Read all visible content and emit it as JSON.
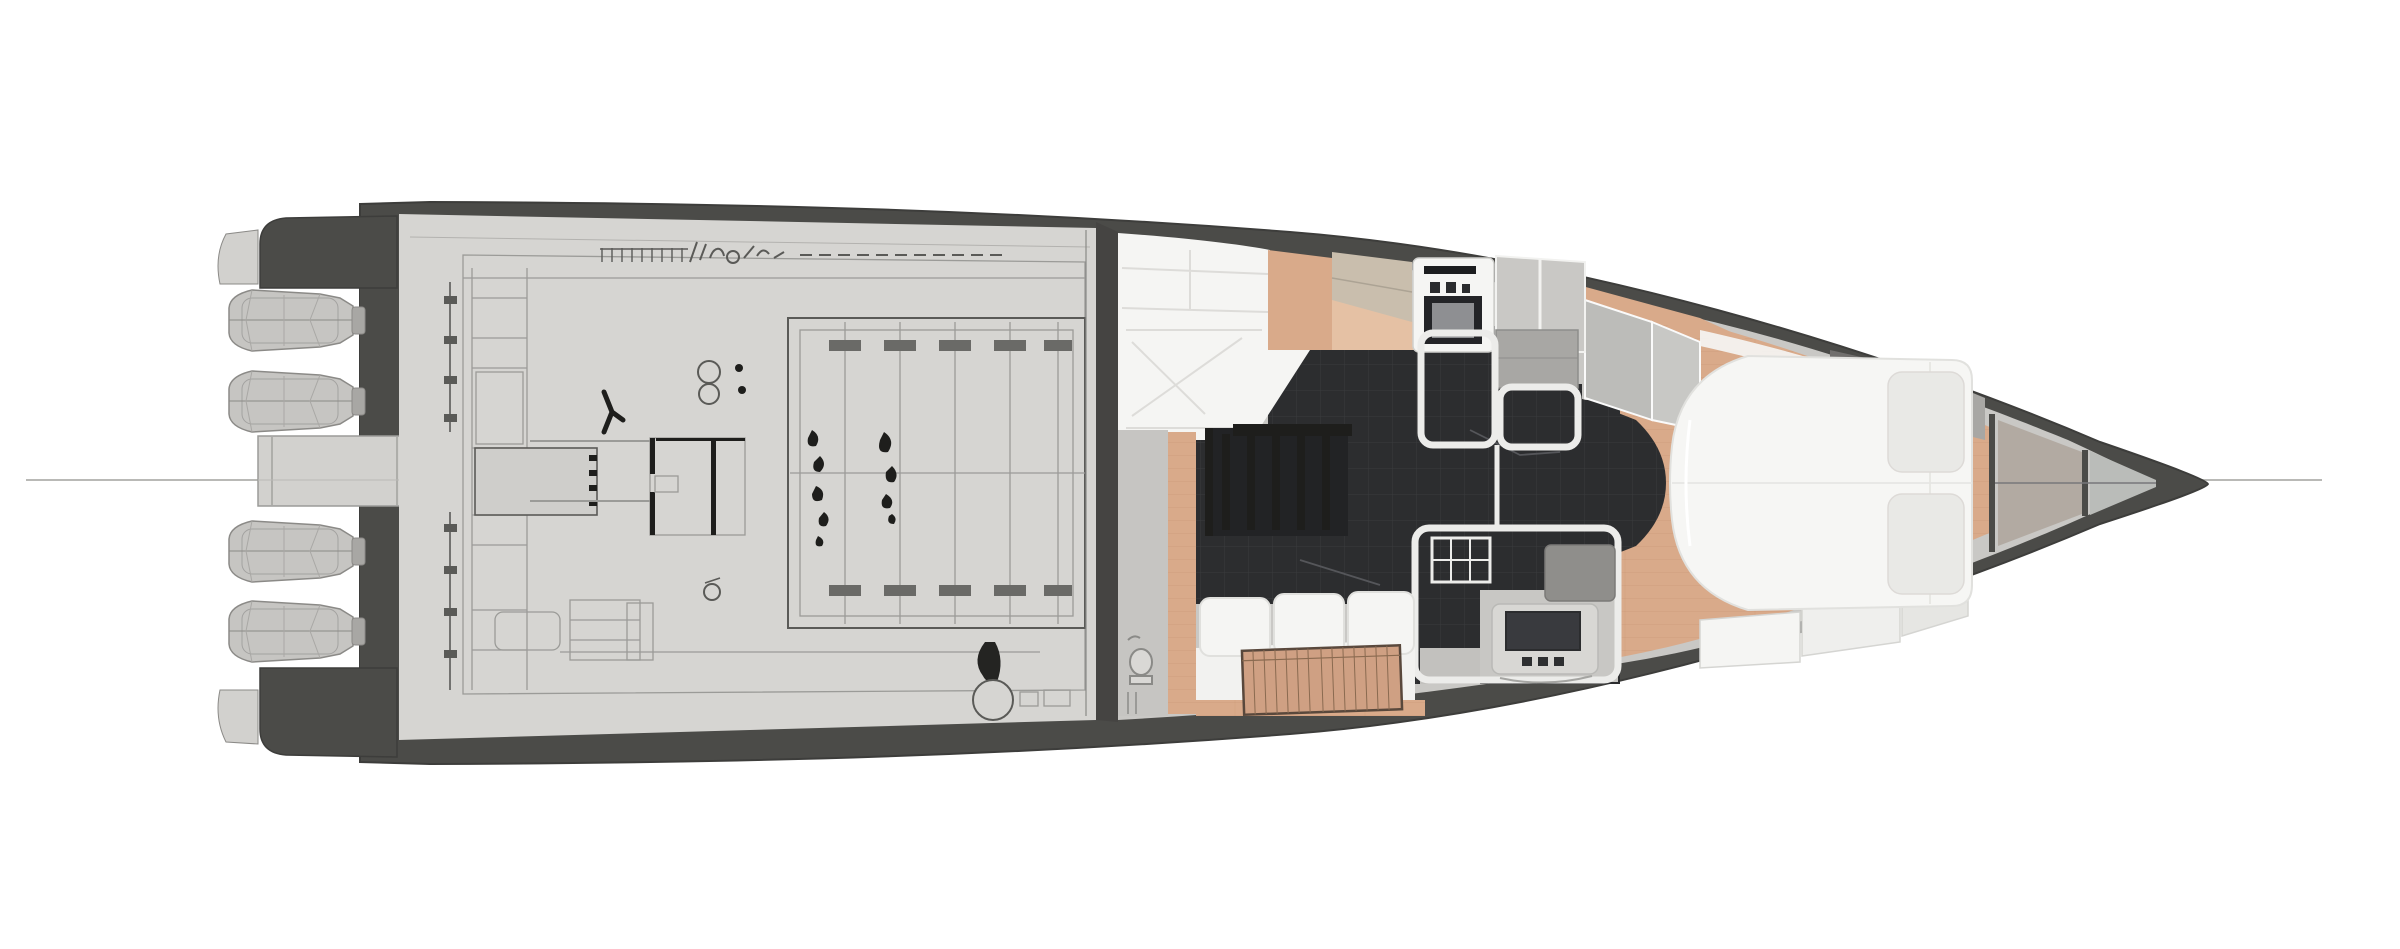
{
  "image": {
    "kind": "yacht-floor-plan-top-view",
    "orientation": "bow-right-stern-left",
    "background": "#ffffff"
  },
  "colors": {
    "bg": "#ffffff",
    "hull": "#4b4b48",
    "hullEdge": "#3d3d3b",
    "deck": "#d6d5d2",
    "deckShade": "#cfcecb",
    "deckLine": "#9b9b98",
    "deckLineDark": "#5a5a57",
    "ink": "#1e1e1c",
    "engine": "#c6c5c2",
    "engineLine": "#8b8a87",
    "platform": "#d2d1ce",
    "bulkhead": "#454442",
    "interiorBase": "#c9c8c5",
    "white": "#f5f5f3",
    "whiteSeam": "#dddcd9",
    "charcoal": "#2c2d2f",
    "charcoalGrid": "#3a3b3e",
    "stairWell": "#222325",
    "wood": "#d9aa8a",
    "woodLine": "#c08f6d",
    "woodLight": "#e5c1a4",
    "beige": "#c9bead",
    "cabinet": "#c9c8c5",
    "cabinetDark": "#a8a7a4",
    "wardrobe": "#716f6d",
    "glass": "#bcbcb9",
    "partition": "#ececea",
    "screen": "#393a3e",
    "bowWarm": "#b2aaa2",
    "bowCool": "#babcb9",
    "centerline": "#b9b9b6",
    "berth": "#8f8e8b",
    "grayFloor": "#c6c5c2"
  },
  "parts": {
    "plan": "Yacht floor plan, top view, bow pointing right",
    "hull": "Hull outline",
    "centerline": "Centerline reference line",
    "engines": "Four outboard engines at transom",
    "platform": "Central swim platform and walkway",
    "deckPlan": "Aft deck technical plan drawing",
    "engineHatch": "Engine compartment hatch with frames",
    "bulkhead": "Main bulkhead between deck and cabin",
    "aftSeating": "Aft cabin seating / sunpad",
    "galley": "Galley cabinetry and appliances",
    "oven": "Oven / appliance column",
    "stairs": "Companionway stairs",
    "head": "Head and shower compartments",
    "guestCabin": "Guest cabin with berth",
    "tv": "TV / media unit",
    "salonSofa": "Salon sofa",
    "table": "Wooden slatted table",
    "woodFloor": "Wood cabin sole",
    "bed": "Owner's double berth",
    "bowLockers": "Forward lockers and cabinets",
    "bowPanels": "Bow storage panels"
  }
}
